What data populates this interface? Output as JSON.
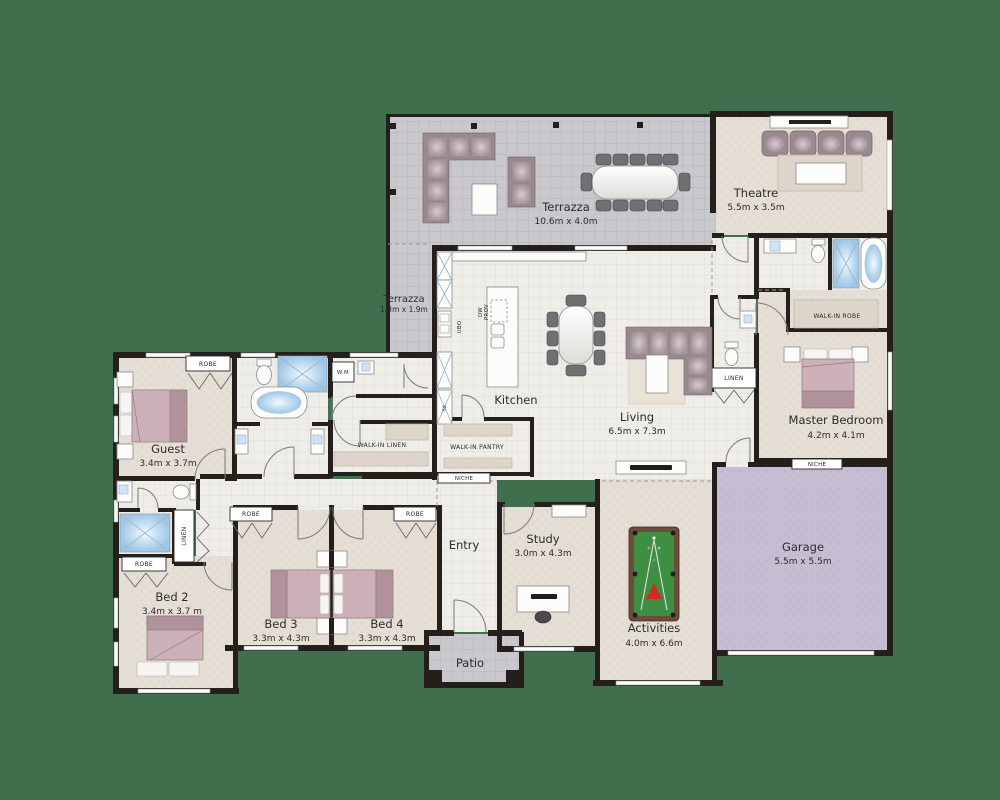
{
  "background": "#406f4e",
  "palette": {
    "wall": "#241f1a",
    "tile_floor": "#efede8",
    "outdoor_floor": "#c9c8cd",
    "room_floor": "#e4ded4",
    "garage_floor": "#c5bdd1",
    "furniture_mauve": "#998a8e",
    "bed_pink": "#ccb2b8",
    "water_blue": "#a8cce8",
    "pool_felt_green": "#3e8f42",
    "label_text": "#2e2c2a"
  },
  "rooms": {
    "terrazza": {
      "name": "Terrazza",
      "dims": "10.6m x 4.0m"
    },
    "terrazza_small": {
      "name": "Terrazza",
      "dims": "1.3m x 1.9m"
    },
    "theatre": {
      "name": "Theatre",
      "dims": "5.5m x 3.5m"
    },
    "master_bedroom": {
      "name": "Master Bedroom",
      "dims": "4.2m x 4.1m"
    },
    "garage": {
      "name": "Garage",
      "dims": "5.5m x 5.5m"
    },
    "living": {
      "name": "Living",
      "dims": "6.5m x 7.3m"
    },
    "kitchen": {
      "name": "Kitchen"
    },
    "guest": {
      "name": "Guest",
      "dims": "3.4m x 3.7m"
    },
    "bed2": {
      "name": "Bed 2",
      "dims": "3.4m x 3.7 m"
    },
    "bed3": {
      "name": "Bed 3",
      "dims": "3.3m x 4.3m"
    },
    "bed4": {
      "name": "Bed 4",
      "dims": "3.3m x 4.3m"
    },
    "study": {
      "name": "Study",
      "dims": "3.0m x 4.3m"
    },
    "activities": {
      "name": "Activities",
      "dims": "4.0m x 6.6m"
    },
    "entry": {
      "name": "Entry"
    },
    "patio": {
      "name": "Patio"
    }
  },
  "closets": {
    "walk_in_robe": "WALK-IN ROBE",
    "walk_in_linen": "WALK-IN LINEN",
    "walk_in_pantry": "WALK-IN PANTRY",
    "robe": "ROBE",
    "linen": "LINEN",
    "niche": "NICHE"
  },
  "appliances": {
    "wm": "W.M",
    "ubo": "UBO",
    "dw": "DW",
    "prov": "PROV",
    "fd": "fd"
  }
}
